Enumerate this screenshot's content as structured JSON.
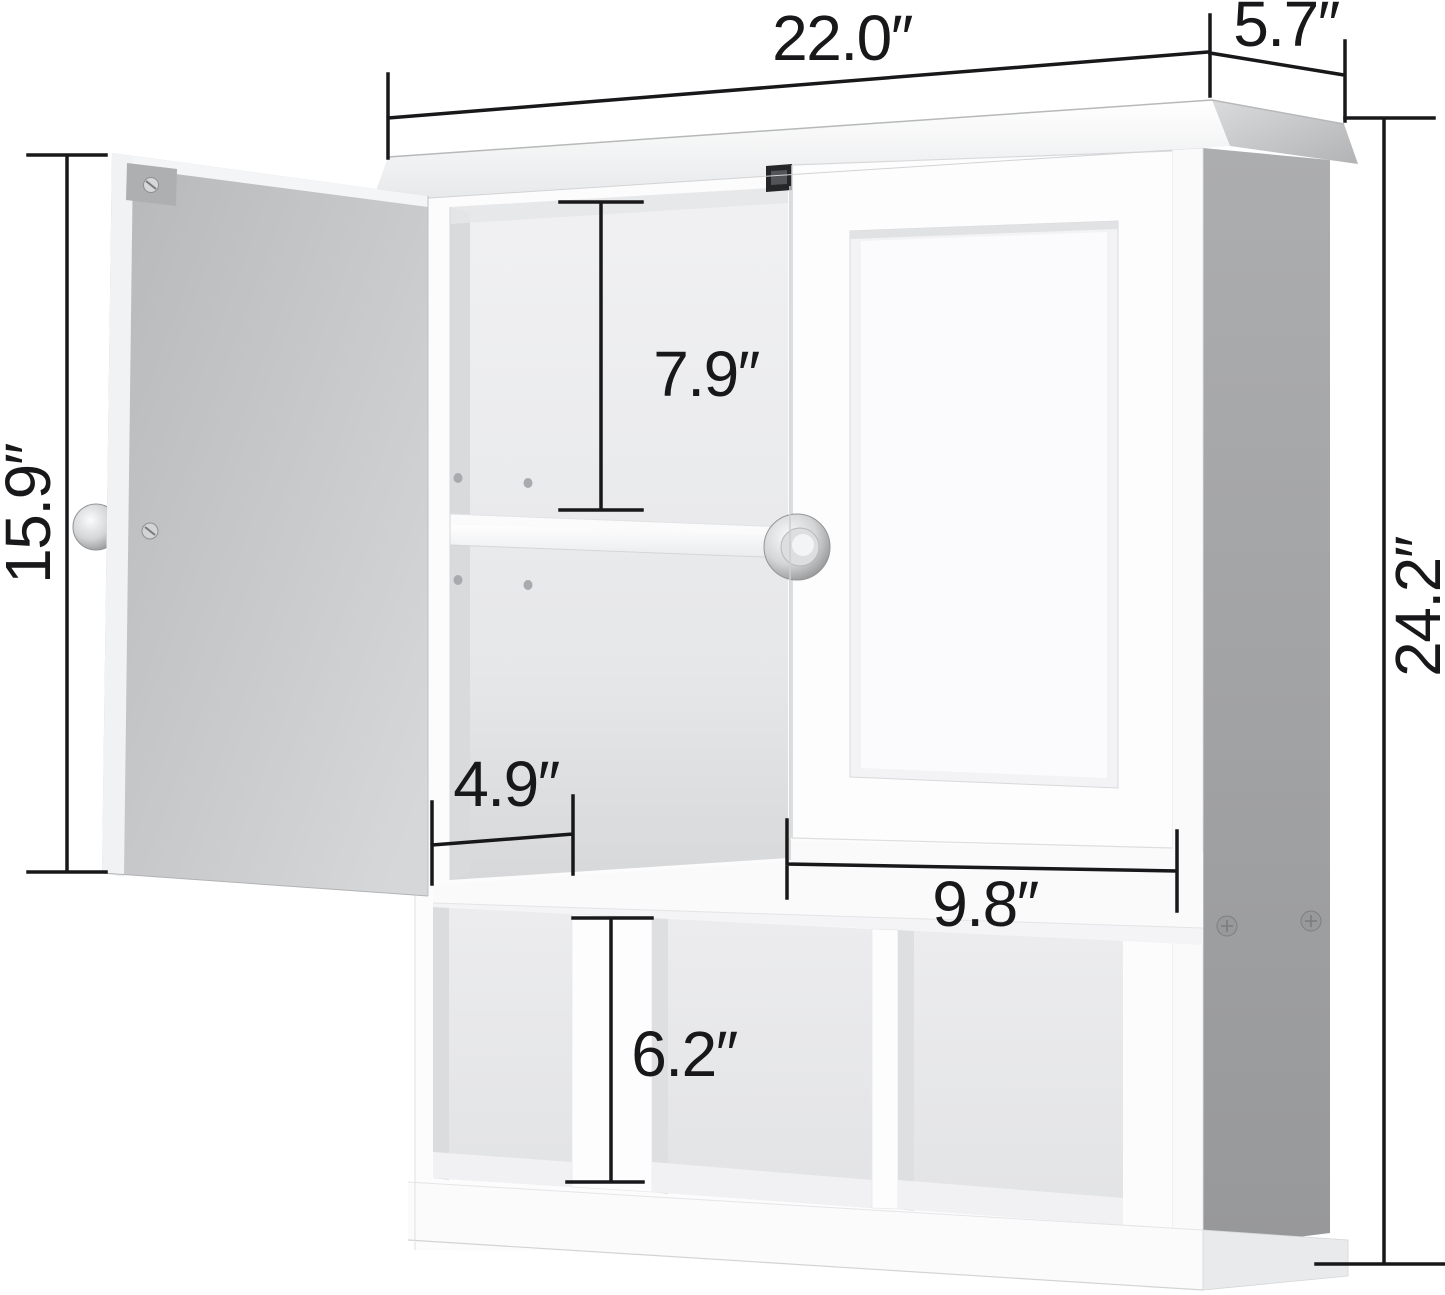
{
  "meta": {
    "type": "product-dimension-diagram",
    "subject": "white wall-mounted bathroom storage cabinet, left mirror-cabinet door open, right shaker door closed, adjustable inner shelf, three open bottom cubbies",
    "units": "inches"
  },
  "colors": {
    "background": "#ffffff",
    "dimension_line": "#18181a",
    "cabinet_white": "#fcfcfd",
    "door_back_gray": "#c6c7c9",
    "side_panel_gray": "#a2a3a5",
    "interior_gray": "#e9eaec",
    "knob_chrome": "#d2d3d5",
    "magnetic_catch_black": "#242628"
  },
  "dimensions": {
    "overall_width": {
      "label": "22.0″",
      "measures": "cabinet top width"
    },
    "top_depth": {
      "label": "5.7″",
      "measures": "cabinet depth at top"
    },
    "door_height": {
      "label": "15.9″",
      "measures": "open door height"
    },
    "overall_height": {
      "label": "24.2″",
      "measures": "overall cabinet height"
    },
    "upper_space": {
      "label": "7.9″",
      "measures": "height above adjustable shelf"
    },
    "shelf_depth": {
      "label": "4.9″",
      "measures": "left open shelf depth"
    },
    "door_width": {
      "label": "9.8″",
      "measures": "right door width"
    },
    "cubby_height": {
      "label": "6.2″",
      "measures": "open cubby height"
    }
  },
  "parts": [
    "crown top",
    "open left door with chrome knob",
    "closed right shaker door with chrome knob",
    "adjustable shelf",
    "shelf pin holes",
    "magnetic door catch",
    "three open cubbies with dividers",
    "base plinth",
    "gray right side panel with screws"
  ]
}
